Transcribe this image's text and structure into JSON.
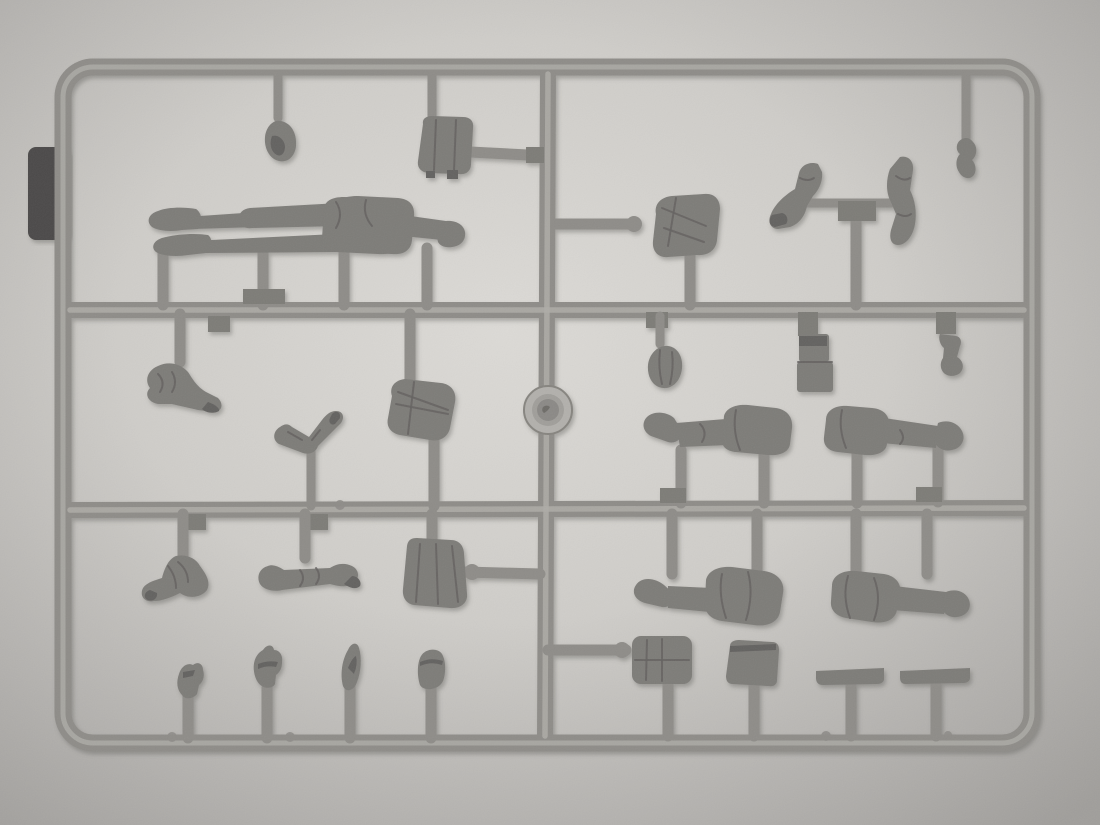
{
  "image": {
    "type": "photograph",
    "subject": "Grey injection-molded plastic sprue of 1/35 scale soldier figure model parts, photographed on light paper background",
    "orientation": "landscape"
  },
  "colors": {
    "bg_center": "#dcdad6",
    "bg_mid": "#cfcdc9",
    "bg_edge": "#b3b1ae",
    "bg_corner": "#a09e9b",
    "runner": "#8e8c88",
    "runner_hi": "#aeaca7",
    "runner_dk": "#7d7b77",
    "part": "#7d7b78",
    "part_dk": "#646260",
    "part_hi": "#9a9793",
    "clip_tab": "#4b4a48",
    "shadow": "#5a5855",
    "disc_outer": "#b2b0ac",
    "disc_mid": "#a09e9a",
    "disc_inner": "#8b8986"
  },
  "sprue": {
    "frame": "rounded rectangular runner frame with three horizontal rails and one central vertical rail",
    "attachment": "dark clip tab on left outer edge",
    "mold_marker": "small circular mold disc on center rail with embossed mark"
  },
  "inventory": [
    {
      "id": "head-top",
      "label": "bare head"
    },
    {
      "id": "mess-tin",
      "label": "mess tin pack with side connector"
    },
    {
      "id": "legs-lying-1",
      "label": "lower body with legs, boots left"
    },
    {
      "id": "legs-lying-2",
      "label": "lower body with legs, boots right"
    },
    {
      "id": "torso-upper-right",
      "label": "torso on side branch"
    },
    {
      "id": "arm-pair-T",
      "label": "two arms on T runner"
    },
    {
      "id": "pistol-part",
      "label": "small pistol part"
    },
    {
      "id": "arm-bent-1",
      "label": "bent arm"
    },
    {
      "id": "arm-pair-V",
      "label": "paired arms in V"
    },
    {
      "id": "torso-mid",
      "label": "tunic torso"
    },
    {
      "id": "grenade",
      "label": "grenade"
    },
    {
      "id": "ammo-pouch",
      "label": "ammunition pouch"
    },
    {
      "id": "holster",
      "label": "pistol holster"
    },
    {
      "id": "legs-lying-3",
      "label": "lower body with legs, boots left"
    },
    {
      "id": "legs-lying-4",
      "label": "lower body with legs, boots right"
    },
    {
      "id": "legs-hanging-5",
      "label": "lower body with legs, boot left"
    },
    {
      "id": "legs-hanging-6",
      "label": "lower body with legs, boot right"
    },
    {
      "id": "arm-bent-3",
      "label": "bent arm with mitten"
    },
    {
      "id": "arm-straight-4",
      "label": "straight arm"
    },
    {
      "id": "torso-greatcoat",
      "label": "greatcoat torso with side connector"
    },
    {
      "id": "head-cap-1",
      "label": "small head"
    },
    {
      "id": "head-cap-2",
      "label": "head with cap"
    },
    {
      "id": "head-hood",
      "label": "head with pointed hood"
    },
    {
      "id": "head-helmet",
      "label": "head with helmet"
    },
    {
      "id": "backpack-1",
      "label": "quilted backpack"
    },
    {
      "id": "backpack-2",
      "label": "square pouch"
    },
    {
      "id": "board-1",
      "label": "flat board strip"
    },
    {
      "id": "board-2",
      "label": "flat board strip"
    }
  ]
}
